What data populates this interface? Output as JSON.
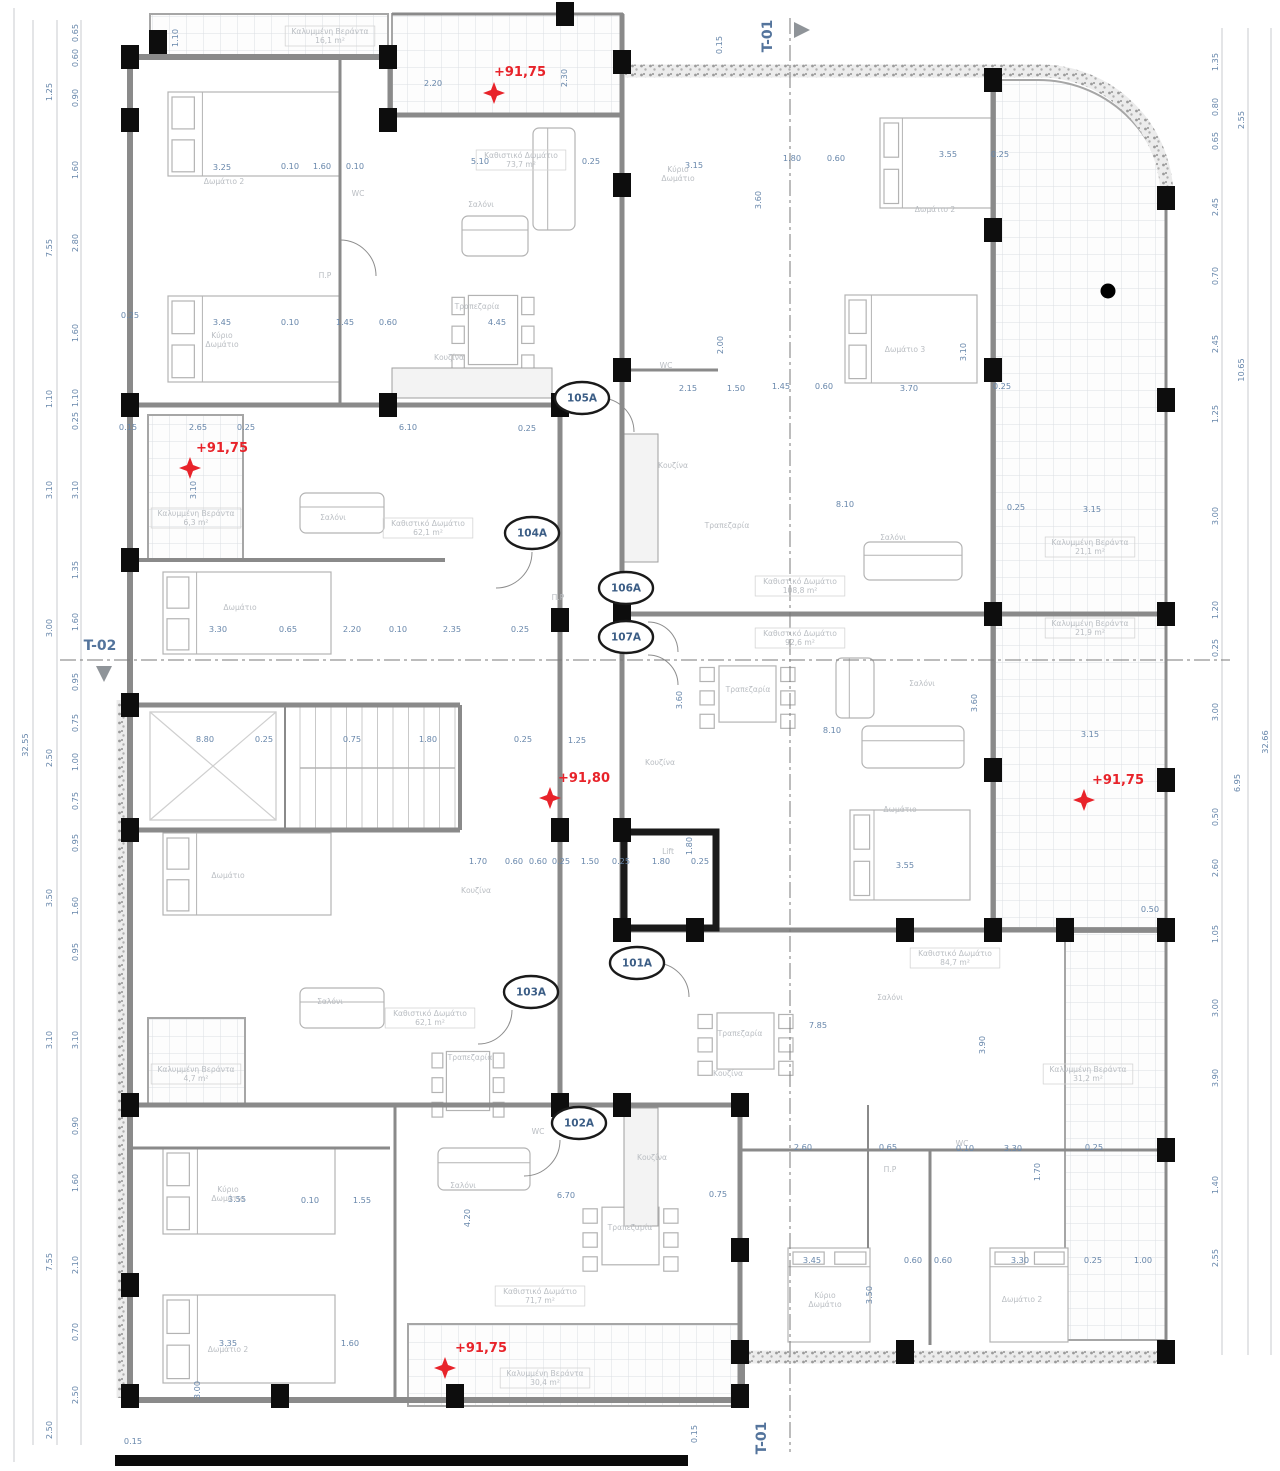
{
  "drawing": {
    "title": "floor-plan",
    "colors": {
      "red_marker": "#e8232a",
      "dim_text": "#6887ab",
      "room_text": "#b9bdc2",
      "bubble_text": "#3c5e86",
      "section_text": "#54749c",
      "wall": "#8a8a8a",
      "column": "#0d0d0d"
    },
    "elevation_markers": [
      {
        "label": "+91,75",
        "x": 520,
        "y": 76,
        "sx": 494,
        "sy": 93
      },
      {
        "label": "+91,75",
        "x": 222,
        "y": 452,
        "sx": 190,
        "sy": 468
      },
      {
        "label": "+91,80",
        "x": 584,
        "y": 782,
        "sx": 550,
        "sy": 798
      },
      {
        "label": "+91,75",
        "x": 1118,
        "y": 784,
        "sx": 1084,
        "sy": 800
      },
      {
        "label": "+91,75",
        "x": 481,
        "y": 1352,
        "sx": 445,
        "sy": 1368
      }
    ],
    "unit_bubbles": [
      {
        "label": "105A",
        "x": 582,
        "y": 398
      },
      {
        "label": "104A",
        "x": 532,
        "y": 533
      },
      {
        "label": "106A",
        "x": 626,
        "y": 588
      },
      {
        "label": "107A",
        "x": 626,
        "y": 637
      },
      {
        "label": "101A",
        "x": 637,
        "y": 963
      },
      {
        "label": "103A",
        "x": 531,
        "y": 992
      },
      {
        "label": "102A",
        "x": 579,
        "y": 1123
      }
    ],
    "section_markers": [
      {
        "label": "T-01",
        "x": 772,
        "y": 36,
        "rot": -90,
        "tri": "right",
        "tx": 794,
        "ty": 30
      },
      {
        "label": "T-02",
        "x": 100,
        "y": 650,
        "rot": 0,
        "tri": "down",
        "tx": 104,
        "ty": 666
      },
      {
        "label": "T-01",
        "x": 766,
        "y": 1438,
        "rot": -90,
        "tri": "none",
        "tx": 0,
        "ty": 0
      }
    ],
    "room_labels": [
      {
        "t": "Καλυμμένη Βεράντα",
        "a": "16,1 m²",
        "x": 330,
        "y": 34
      },
      {
        "t": "Καθιστικό Δωμάτιο",
        "a": "73,7 m²",
        "x": 521,
        "y": 158
      },
      {
        "t": "Σαλόνι",
        "x": 481,
        "y": 207
      },
      {
        "t": "Τραπεζαρία",
        "x": 477,
        "y": 309
      },
      {
        "t": "Κουζίνα",
        "x": 449,
        "y": 360
      },
      {
        "t": "Δωμάτιο 2",
        "x": 224,
        "y": 184
      },
      {
        "t": "Κύριο",
        "t2": "Δωμάτιο",
        "x": 222,
        "y": 338
      },
      {
        "t": "WC",
        "x": 358,
        "y": 196
      },
      {
        "t": "Π.P",
        "x": 325,
        "y": 278
      },
      {
        "t": "Κύριο",
        "t2": "Δωμάτιο",
        "x": 678,
        "y": 172
      },
      {
        "t": "Δωμάτιο 2",
        "x": 935,
        "y": 212
      },
      {
        "t": "Δωμάτιο 3",
        "x": 905,
        "y": 352
      },
      {
        "t": "WC",
        "x": 666,
        "y": 368
      },
      {
        "t": "Κουζίνα",
        "x": 673,
        "y": 468
      },
      {
        "t": "Τραπεζαρία",
        "x": 727,
        "y": 528
      },
      {
        "t": "Σαλόνι",
        "x": 893,
        "y": 540
      },
      {
        "t": "Καθιστικό Δωμάτιο",
        "a": "108,8 m²",
        "x": 800,
        "y": 584
      },
      {
        "t": "Καλυμμένη Βεράντα",
        "a": "21,1 m²",
        "x": 1090,
        "y": 545
      },
      {
        "t": "Καλυμμένη Βεράντα",
        "a": "21,9 m²",
        "x": 1090,
        "y": 626
      },
      {
        "t": "Καθιστικό Δωμάτιο",
        "a": "92,6 m²",
        "x": 800,
        "y": 636
      },
      {
        "t": "Τραπεζαρία",
        "x": 748,
        "y": 692
      },
      {
        "t": "Σαλόνι",
        "x": 922,
        "y": 686
      },
      {
        "t": "Κουζίνα",
        "x": 660,
        "y": 765
      },
      {
        "t": "Δωμάτιο",
        "x": 900,
        "y": 812
      },
      {
        "t": "Lift",
        "x": 668,
        "y": 854
      },
      {
        "t": "Καθιστικό Δωμάτιο",
        "a": "62,1 m²",
        "x": 428,
        "y": 526
      },
      {
        "t": "Σαλόνι",
        "x": 333,
        "y": 520
      },
      {
        "t": "Δωμάτιο",
        "x": 240,
        "y": 610
      },
      {
        "t": "Δωμάτιο",
        "x": 228,
        "y": 878
      },
      {
        "t": "Π.P",
        "x": 558,
        "y": 600
      },
      {
        "t": "Καλυμμένη Βεράντα",
        "a": "6,3 m²",
        "x": 196,
        "y": 516
      },
      {
        "t": "Κουζίνα",
        "x": 476,
        "y": 893
      },
      {
        "t": "Καθιστικό Δωμάτιο",
        "a": "62,1 m²",
        "x": 430,
        "y": 1016
      },
      {
        "t": "Σαλόνι",
        "x": 330,
        "y": 1004
      },
      {
        "t": "Τραπεζαρία",
        "x": 470,
        "y": 1060
      },
      {
        "t": "Καλυμμένη Βεράντα",
        "a": "4,7 m²",
        "x": 196,
        "y": 1072
      },
      {
        "t": "WC",
        "x": 538,
        "y": 1134
      },
      {
        "t": "Κύριο",
        "t2": "Δωμάτιο",
        "x": 228,
        "y": 1192
      },
      {
        "t": "Δωμάτιο 2",
        "x": 228,
        "y": 1352
      },
      {
        "t": "Σαλόνι",
        "x": 463,
        "y": 1188
      },
      {
        "t": "Τραπεζαρία",
        "x": 630,
        "y": 1230
      },
      {
        "t": "Κουζίνα",
        "x": 652,
        "y": 1160
      },
      {
        "t": "Καθιστικό Δωμάτιο",
        "a": "71,7 m²",
        "x": 540,
        "y": 1294
      },
      {
        "t": "Καλυμμένη Βεράντα",
        "a": "30,4 m²",
        "x": 545,
        "y": 1376
      },
      {
        "t": "Κύριο",
        "t2": "Δωμάτιο",
        "x": 825,
        "y": 1298
      },
      {
        "t": "Δωμάτιο 2",
        "x": 1022,
        "y": 1302
      },
      {
        "t": "Σαλόνι",
        "x": 890,
        "y": 1000
      },
      {
        "t": "Τραπεζαρία",
        "x": 740,
        "y": 1036
      },
      {
        "t": "Κουζίνα",
        "x": 728,
        "y": 1076
      },
      {
        "t": "Καθιστικό Δωμάτιο",
        "a": "84,7 m²",
        "x": 955,
        "y": 956
      },
      {
        "t": "Καλυμμένη Βεράντα",
        "a": "31,2 m²",
        "x": 1088,
        "y": 1072
      },
      {
        "t": "WC",
        "x": 962,
        "y": 1146
      },
      {
        "t": "Π.P",
        "x": 890,
        "y": 1172
      }
    ],
    "dim_labels": [
      [
        "32.55",
        28,
        745,
        -90
      ],
      [
        "1.25",
        52,
        92,
        -90
      ],
      [
        "7.55",
        52,
        248,
        -90
      ],
      [
        "1.10",
        52,
        399,
        -90
      ],
      [
        "3.10",
        52,
        490,
        -90
      ],
      [
        "3.00",
        52,
        628,
        -90
      ],
      [
        "2.50",
        52,
        758,
        -90
      ],
      [
        "3.50",
        52,
        898,
        -90
      ],
      [
        "3.10",
        52,
        1040,
        -90
      ],
      [
        "7.55",
        52,
        1262,
        -90
      ],
      [
        "2.50",
        52,
        1430,
        -90
      ],
      [
        "0.65",
        78,
        33,
        -90
      ],
      [
        "0.60",
        78,
        58,
        -90
      ],
      [
        "0.90",
        78,
        98,
        -90
      ],
      [
        "1.60",
        78,
        170,
        -90
      ],
      [
        "2.80",
        78,
        243,
        -90
      ],
      [
        "1.60",
        78,
        333,
        -90
      ],
      [
        "1.10",
        78,
        398,
        -90
      ],
      [
        "0.25",
        78,
        421,
        -90
      ],
      [
        "3.10",
        78,
        490,
        -90
      ],
      [
        "1.35",
        78,
        570,
        -90
      ],
      [
        "1.60",
        78,
        622,
        -90
      ],
      [
        "0.95",
        78,
        682,
        -90
      ],
      [
        "0.75",
        78,
        723,
        -90
      ],
      [
        "1.00",
        78,
        762,
        -90
      ],
      [
        "0.75",
        78,
        801,
        -90
      ],
      [
        "0.95",
        78,
        843,
        -90
      ],
      [
        "1.60",
        78,
        906,
        -90
      ],
      [
        "0.95",
        78,
        952,
        -90
      ],
      [
        "3.10",
        78,
        1040,
        -90
      ],
      [
        "0.90",
        78,
        1126,
        -90
      ],
      [
        "1.60",
        78,
        1183,
        -90
      ],
      [
        "2.10",
        78,
        1265,
        -90
      ],
      [
        "0.70",
        78,
        1332,
        -90
      ],
      [
        "2.50",
        78,
        1395,
        -90
      ],
      [
        "0.25",
        130,
        318,
        0
      ],
      [
        "0.15",
        128,
        430,
        0
      ],
      [
        "1.35",
        1218,
        62,
        -90
      ],
      [
        "0.80",
        1218,
        107,
        -90
      ],
      [
        "0.65",
        1218,
        141,
        -90
      ],
      [
        "2.45",
        1218,
        207,
        -90
      ],
      [
        "0.70",
        1218,
        276,
        -90
      ],
      [
        "2.45",
        1218,
        344,
        -90
      ],
      [
        "1.25",
        1218,
        414,
        -90
      ],
      [
        "3.00",
        1218,
        516,
        -90
      ],
      [
        "1.20",
        1218,
        610,
        -90
      ],
      [
        "0.25",
        1218,
        648,
        -90
      ],
      [
        "3.00",
        1218,
        712,
        -90
      ],
      [
        "0.50",
        1218,
        817,
        -90
      ],
      [
        "2.60",
        1218,
        868,
        -90
      ],
      [
        "1.05",
        1218,
        934,
        -90
      ],
      [
        "3.00",
        1218,
        1008,
        -90
      ],
      [
        "3.90",
        1218,
        1078,
        -90
      ],
      [
        "1.40",
        1218,
        1185,
        -90
      ],
      [
        "2.55",
        1218,
        1258,
        -90
      ],
      [
        "2.55",
        1244,
        120,
        -90
      ],
      [
        "10.65",
        1244,
        370,
        -90
      ],
      [
        "6.95",
        1240,
        783,
        -90
      ],
      [
        "32.66",
        1268,
        742,
        -90
      ],
      [
        "1.10",
        178,
        38,
        -90
      ],
      [
        "2.20",
        433,
        86,
        0
      ],
      [
        "2.30",
        567,
        78,
        -90
      ],
      [
        "0.15",
        722,
        45,
        -90
      ],
      [
        "0.10",
        290,
        169,
        0
      ],
      [
        "1.60",
        322,
        169,
        0
      ],
      [
        "0.10",
        355,
        169,
        0
      ],
      [
        "3.25",
        222,
        170,
        0
      ],
      [
        "3.45",
        222,
        325,
        0
      ],
      [
        "0.10",
        290,
        325,
        0
      ],
      [
        "1.45",
        345,
        325,
        0
      ],
      [
        "0.60",
        388,
        325,
        0
      ],
      [
        "5.10",
        480,
        164,
        0
      ],
      [
        "0.25",
        591,
        164,
        0
      ],
      [
        "4.45",
        497,
        325,
        0
      ],
      [
        "3.15",
        694,
        168,
        0
      ],
      [
        "1.80",
        792,
        161,
        0
      ],
      [
        "0.60",
        836,
        161,
        0
      ],
      [
        "3.55",
        948,
        157,
        0
      ],
      [
        "0.25",
        1000,
        157,
        0
      ],
      [
        "3.60",
        761,
        200,
        -90
      ],
      [
        "2.00",
        723,
        345,
        -90
      ],
      [
        "3.10",
        966,
        352,
        -90
      ],
      [
        "2.15",
        688,
        391,
        0
      ],
      [
        "1.50",
        736,
        391,
        0
      ],
      [
        "1.45",
        781,
        389,
        0
      ],
      [
        "0.60",
        824,
        389,
        0
      ],
      [
        "3.70",
        909,
        391,
        0
      ],
      [
        "0.25",
        1002,
        389,
        0
      ],
      [
        "2.65",
        198,
        430,
        0
      ],
      [
        "0.25",
        246,
        430,
        0
      ],
      [
        "6.10",
        408,
        430,
        0
      ],
      [
        "0.25",
        527,
        431,
        0
      ],
      [
        "3.10",
        196,
        490,
        -90
      ],
      [
        "3.30",
        218,
        632,
        0
      ],
      [
        "0.65",
        288,
        632,
        0
      ],
      [
        "2.20",
        352,
        632,
        0
      ],
      [
        "0.10",
        398,
        632,
        0
      ],
      [
        "2.35",
        452,
        632,
        0
      ],
      [
        "0.25",
        520,
        632,
        0
      ],
      [
        "8.80",
        205,
        742,
        0
      ],
      [
        "0.25",
        264,
        742,
        0
      ],
      [
        "0.75",
        352,
        742,
        0
      ],
      [
        "1.80",
        428,
        742,
        0
      ],
      [
        "0.25",
        523,
        742,
        0
      ],
      [
        "1.25",
        577,
        743,
        0
      ],
      [
        "1.70",
        478,
        864,
        0
      ],
      [
        "0.60",
        514,
        864,
        0
      ],
      [
        "0.60",
        538,
        864,
        0
      ],
      [
        "0.25",
        561,
        864,
        0
      ],
      [
        "1.50",
        590,
        864,
        0
      ],
      [
        "0.25",
        621,
        864,
        0
      ],
      [
        "1.80",
        661,
        864,
        0
      ],
      [
        "0.25",
        700,
        864,
        0
      ],
      [
        "1.80",
        692,
        846,
        -90
      ],
      [
        "3.55",
        905,
        868,
        0
      ],
      [
        "8.10",
        845,
        507,
        0
      ],
      [
        "8.10",
        832,
        733,
        0
      ],
      [
        "3.60",
        977,
        703,
        -90
      ],
      [
        "3.60",
        682,
        700,
        -90
      ],
      [
        "3.15",
        1092,
        512,
        0
      ],
      [
        "0.25",
        1016,
        510,
        0
      ],
      [
        "3.15",
        1090,
        737,
        0
      ],
      [
        "0.50",
        1150,
        912,
        0
      ],
      [
        "7.85",
        818,
        1028,
        0
      ],
      [
        "3.90",
        985,
        1045,
        -90
      ],
      [
        "3.55",
        237,
        1202,
        0
      ],
      [
        "0.10",
        310,
        1203,
        0
      ],
      [
        "1.55",
        362,
        1203,
        0
      ],
      [
        "3.35",
        228,
        1346,
        0
      ],
      [
        "1.60",
        350,
        1346,
        0
      ],
      [
        "3.00",
        200,
        1390,
        -90
      ],
      [
        "6.70",
        566,
        1198,
        0
      ],
      [
        "0.75",
        718,
        1197,
        0
      ],
      [
        "4.20",
        470,
        1218,
        -90
      ],
      [
        "2.60",
        803,
        1150,
        0
      ],
      [
        "0.65",
        888,
        1150,
        0
      ],
      [
        "0.10",
        965,
        1151,
        0
      ],
      [
        "3.30",
        1013,
        1151,
        0
      ],
      [
        "0.25",
        1094,
        1150,
        0
      ],
      [
        "3.45",
        812,
        1263,
        0
      ],
      [
        "0.60",
        913,
        1263,
        0
      ],
      [
        "0.60",
        943,
        1263,
        0
      ],
      [
        "3.30",
        1020,
        1263,
        0
      ],
      [
        "0.25",
        1093,
        1263,
        0
      ],
      [
        "1.00",
        1143,
        1263,
        0
      ],
      [
        "1.70",
        1040,
        1172,
        -90
      ],
      [
        "3.50",
        872,
        1295,
        -90
      ],
      [
        "0.15",
        697,
        1434,
        -90
      ],
      [
        "0.15",
        133,
        1444,
        0
      ]
    ],
    "black_dot": {
      "x": 1108,
      "y": 291
    }
  }
}
